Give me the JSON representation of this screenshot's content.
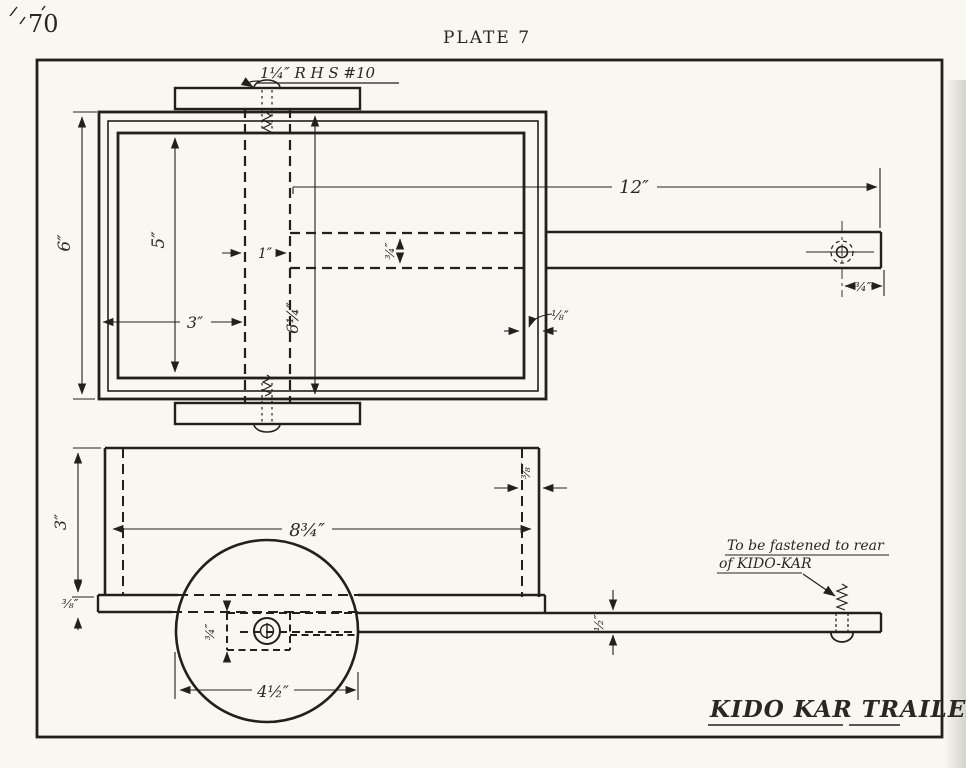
{
  "page": {
    "number": "70",
    "plate_title": "PLATE 7"
  },
  "drawing_title": "KIDO KAR TRAILER",
  "hardware_label": "1¼″ R H S #10",
  "fastening_note": {
    "line1": "To be fastened to rear",
    "line2": "of KIDO-KAR"
  },
  "plan_dims": {
    "overall_width": "6″",
    "inner_width": "5″",
    "rear_offset": "3″",
    "axle_board_width": "1″",
    "box_length": "6¼″",
    "tongue_width": "¾″",
    "tongue_length": "12″",
    "wall_thickness": "⅛″",
    "hole_offset": "¾″"
  },
  "side_dims": {
    "box_height": "3″",
    "floor_thickness": "⅜″",
    "box_length": "8¾″",
    "wall_thickness": "⅜″",
    "tongue_thickness": "½″",
    "wheel_diameter": "4½″",
    "hub_offset": "¾″"
  },
  "colors": {
    "ink": "#23201c",
    "paper": "#f8f7f2"
  }
}
